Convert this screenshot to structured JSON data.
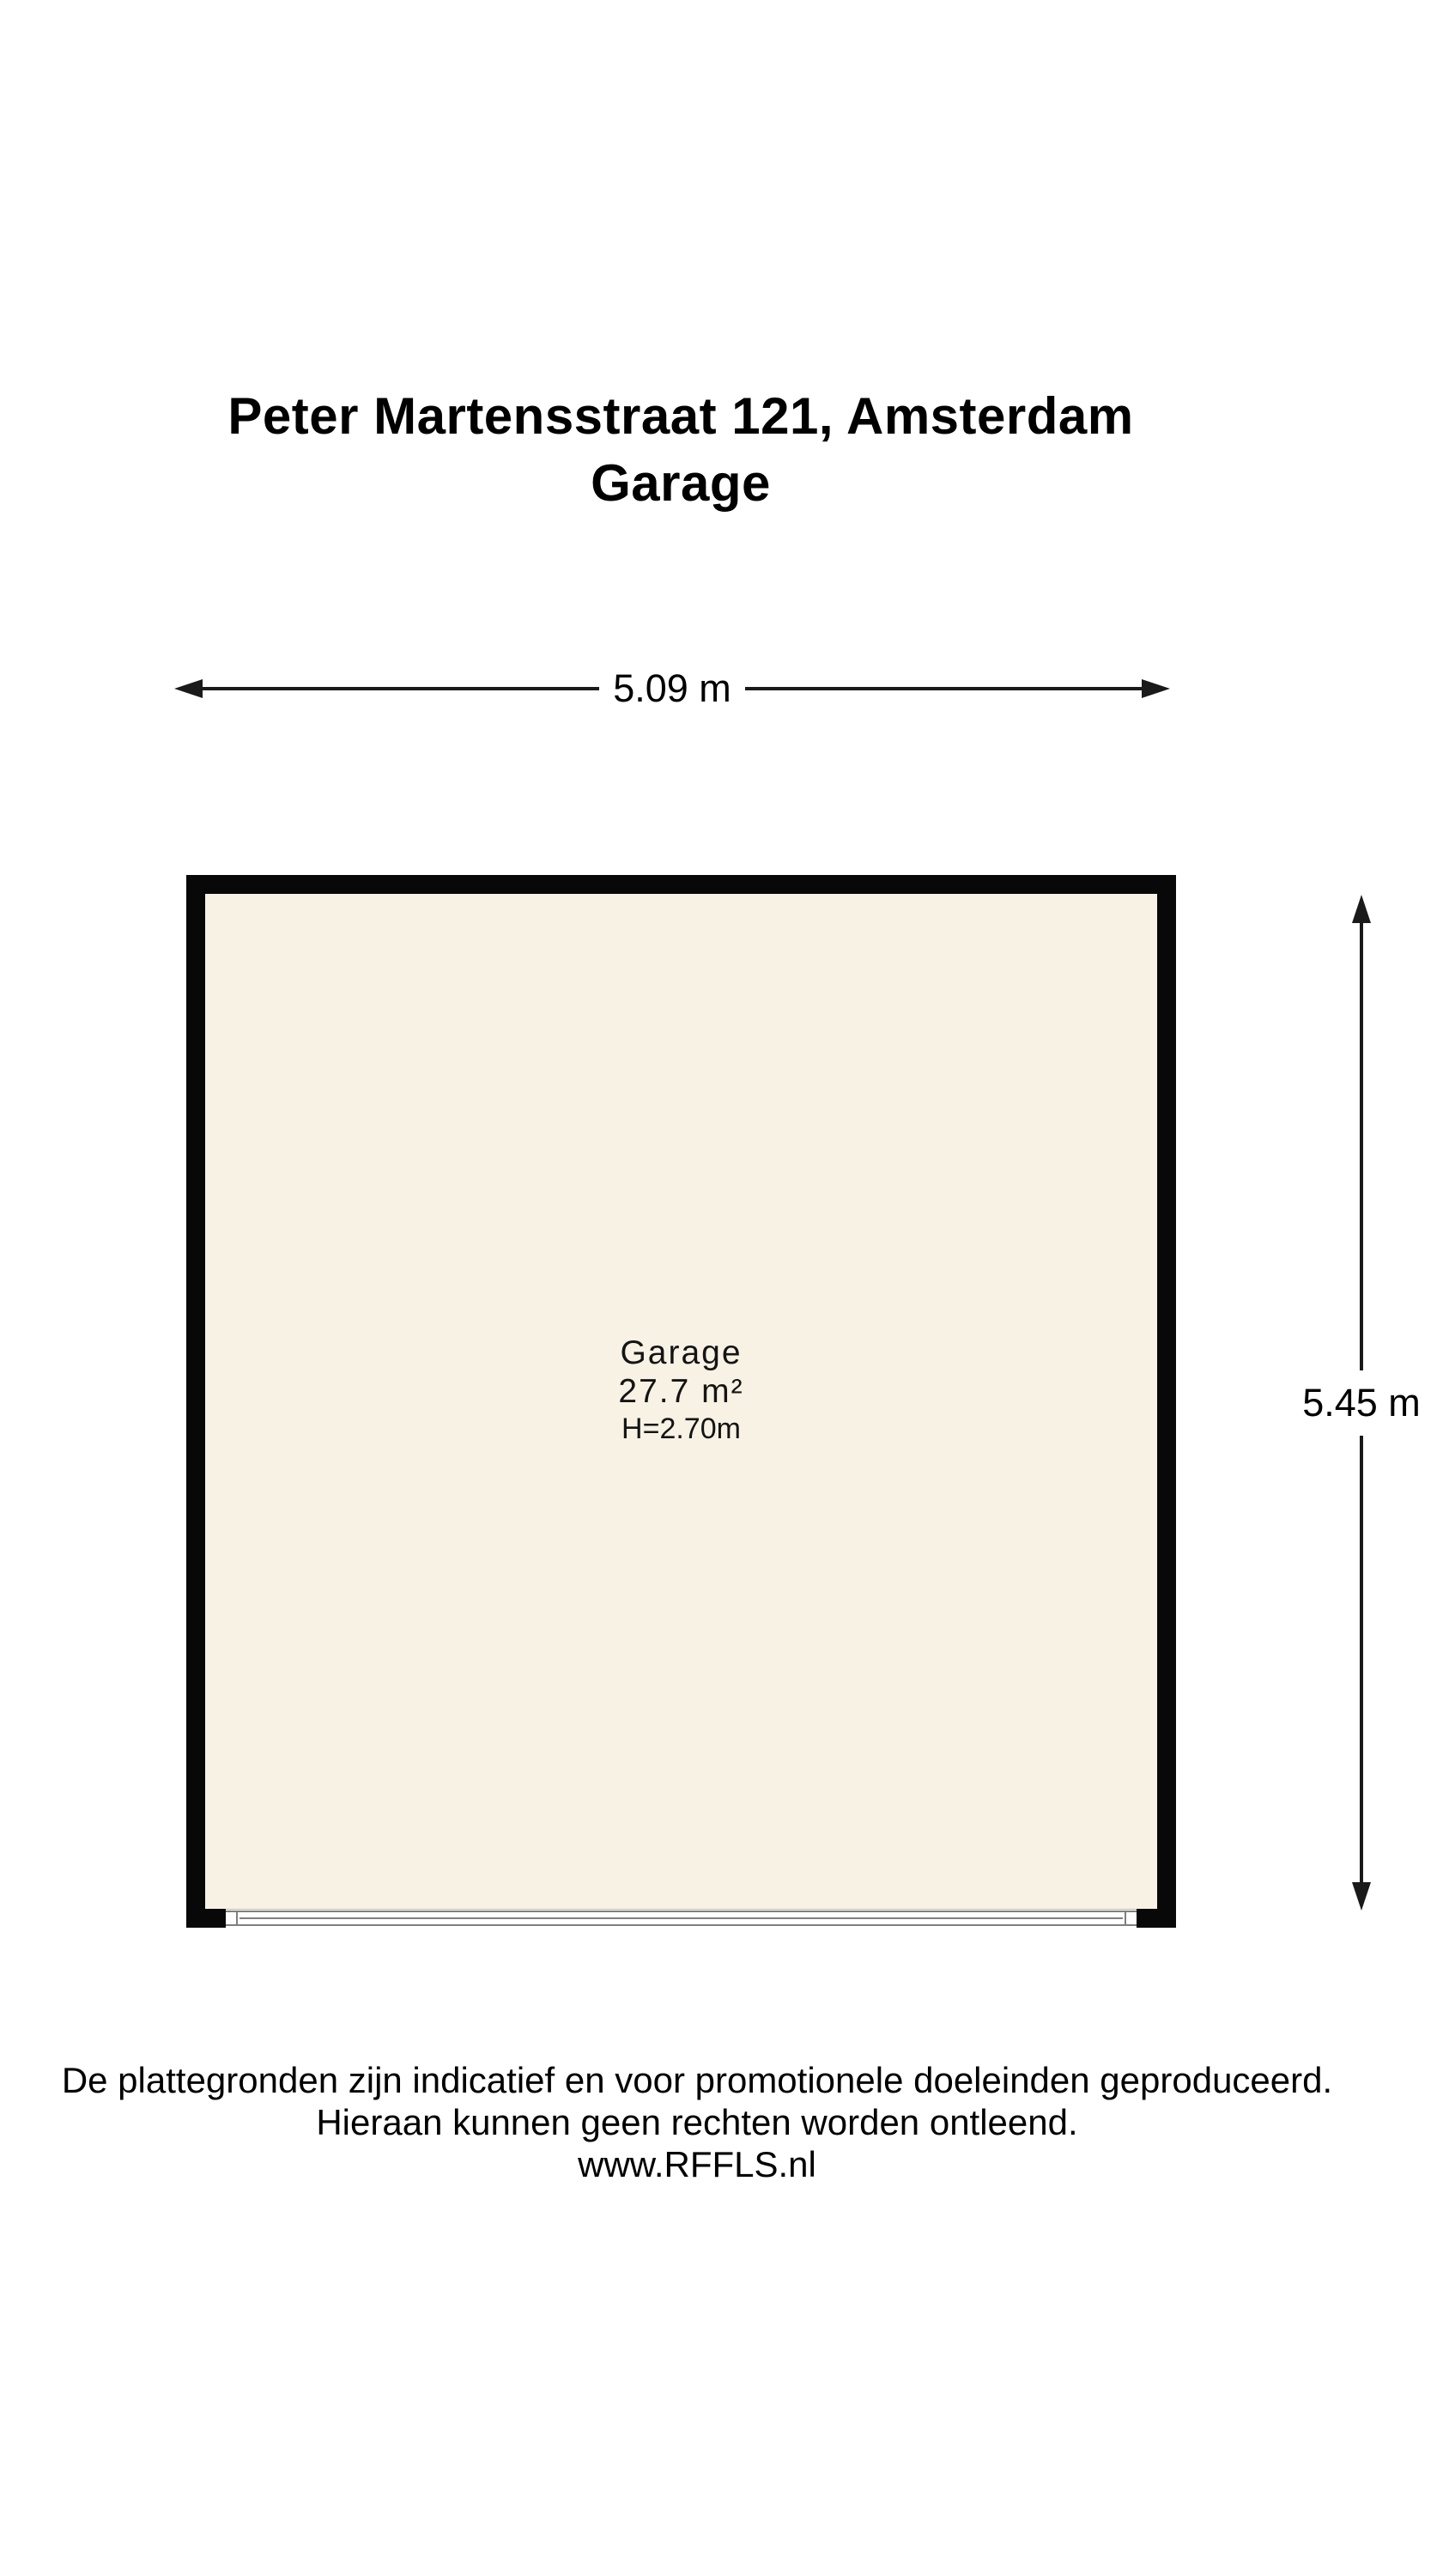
{
  "title": {
    "address": "Peter Martensstraat 121, Amsterdam",
    "floor": "Garage"
  },
  "dimensions": {
    "width_label": "5.09 m",
    "height_label": "5.45 m"
  },
  "room": {
    "name": "Garage",
    "area": "27.7 m²",
    "ceiling_height": "H=2.70m"
  },
  "disclaimer": {
    "line1": "De plattegronden zijn indicatief en voor promotionele doeleinden geproduceerd.",
    "line2": "Hieraan kunnen geen rechten worden ontleend.",
    "line3": "www.RFFLS.nl"
  },
  "colors": {
    "background": "#FFFFFF",
    "wall": "#080808",
    "floor": "#F7F2E4",
    "dimension_line": "#1A1A1A",
    "strip_line": "#7F7F7F",
    "interior_outline": "#BDB9AC",
    "text": "#000000"
  }
}
